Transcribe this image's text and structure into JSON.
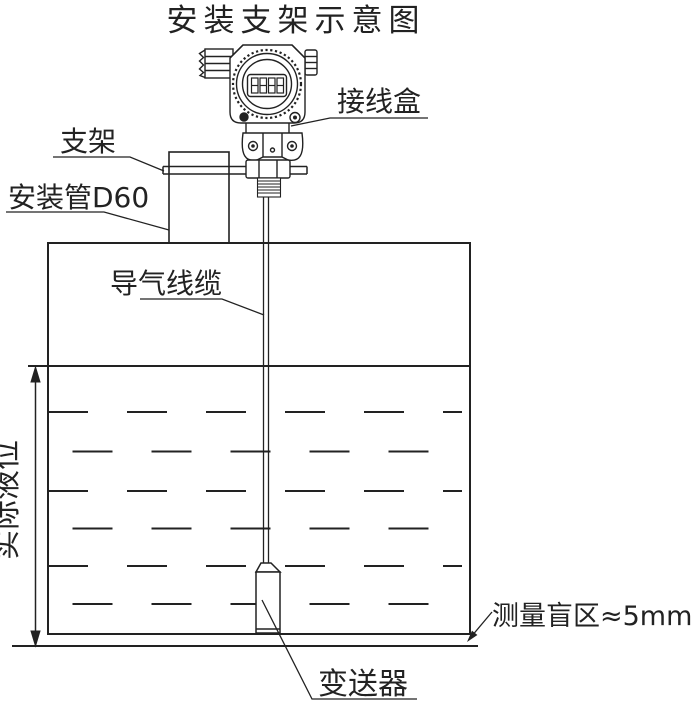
{
  "title": "安装支架示意图",
  "labels": {
    "junction_box": "接线盒",
    "bracket": "支架",
    "mounting_pipe": "安装管D60",
    "air_cable": "导气线缆",
    "actual_level": "实际液位",
    "blind_zone": "测量盲区≈5mm",
    "transmitter": "变送器"
  },
  "icons": {
    "lcd_display": "four-digit-segment-display",
    "knurled_bezel": "circular-knurled-ring",
    "cable_gland": "hex-cable-gland",
    "dimension_arrow": "double-headed-vertical-arrow",
    "leader_arrow": "filled-arrowhead"
  },
  "colors": {
    "line": "#222222",
    "background": "#ffffff"
  }
}
